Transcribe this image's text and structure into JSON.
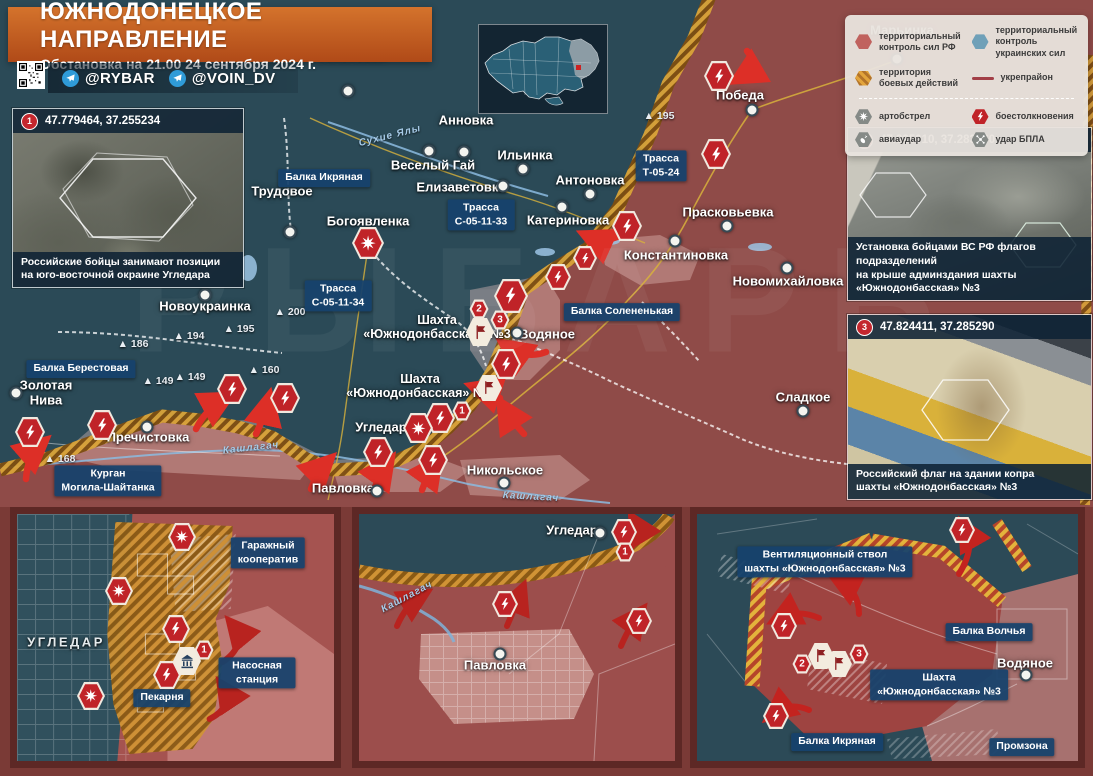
{
  "header": {
    "title": "ЮЖНОДОНЕЦКОЕ НАПРАВЛЕНИЕ",
    "subtitle": "Обстановка на 21.00 24 сентября 2024 г.",
    "channels": [
      {
        "label": "@RYBAR"
      },
      {
        "label": "@VOIN_DV"
      }
    ]
  },
  "legend": {
    "items": [
      {
        "type": "zone-rf",
        "label": "территориальный контроль сил РФ"
      },
      {
        "type": "zone-ua",
        "label": "территориальный контроль украинских сил"
      },
      {
        "type": "zone-combat",
        "label": "территория боевых действий"
      },
      {
        "type": "fortline",
        "label": "укрепрайон"
      },
      {
        "type": "artillery",
        "label": "артобстрел"
      },
      {
        "type": "clash",
        "label": "боестолкновения"
      },
      {
        "type": "airstrike",
        "label": "авиаудар"
      },
      {
        "type": "drone",
        "label": "удар БПЛА"
      }
    ]
  },
  "photos": [
    {
      "num": "1",
      "coords": "47.779464, 37.255234",
      "caption": "Российские бойцы занимают позиции\nна юго-восточной окраине Угледара"
    },
    {
      "num": "2",
      "coords": "47.825010, 37.283660",
      "caption": "Установка бойцами ВС РФ флагов подразделений\nна крыше админздания шахты «Южнодонбасская» №3"
    },
    {
      "num": "3",
      "coords": "47.824411, 37.285290",
      "caption": "Российский флаг на здании копра\nшахты «Южнодонбасская» №3"
    }
  ],
  "map": {
    "watermark": "РЫБАРЬ",
    "towns": [
      {
        "name": "Марьинка",
        "x": 902,
        "y": 31,
        "dot": [
          897,
          59
        ]
      },
      {
        "name": "Победа",
        "x": 740,
        "y": 96,
        "dot": [
          752,
          110
        ]
      },
      {
        "name": "Успеновка",
        "x": 352,
        "y": 56,
        "dot": [
          348,
          91
        ]
      },
      {
        "name": "Анновка",
        "x": 466,
        "y": 121,
        "dot": [
          464,
          152
        ]
      },
      {
        "name": "Трудовое",
        "x": 282,
        "y": 192,
        "dot": [
          290,
          232
        ]
      },
      {
        "name": "Веселый Гай",
        "x": 433,
        "y": 166,
        "dot": [
          429,
          151
        ]
      },
      {
        "name": "Ильинка",
        "x": 525,
        "y": 156,
        "dot": [
          523,
          169
        ]
      },
      {
        "name": "Елизаветовка",
        "x": 461,
        "y": 188,
        "dot": [
          503,
          186
        ]
      },
      {
        "name": "Антоновка",
        "x": 590,
        "y": 181,
        "dot": [
          590,
          194
        ]
      },
      {
        "name": "Катериновка",
        "x": 568,
        "y": 221,
        "dot": [
          562,
          207
        ]
      },
      {
        "name": "Прасковьевка",
        "x": 728,
        "y": 213,
        "dot": [
          727,
          226
        ]
      },
      {
        "name": "Константиновка",
        "x": 676,
        "y": 256,
        "dot": [
          675,
          241
        ]
      },
      {
        "name": "Новомихайловка",
        "x": 788,
        "y": 282,
        "dot": [
          787,
          268
        ]
      },
      {
        "name": "Богоявленка",
        "x": 368,
        "y": 222
      },
      {
        "name": "Новоукраинка",
        "x": 205,
        "y": 307,
        "dot": [
          205,
          295
        ]
      },
      {
        "name": "Золотая\nНива",
        "x": 46,
        "y": 393,
        "dot": [
          16,
          393
        ]
      },
      {
        "name": "Пречистовка",
        "x": 148,
        "y": 438,
        "dot": [
          147,
          427
        ]
      },
      {
        "name": "Угледар",
        "x": 381,
        "y": 428
      },
      {
        "name": "Павловка",
        "x": 343,
        "y": 489,
        "dot": [
          377,
          491
        ]
      },
      {
        "name": "Никольское",
        "x": 505,
        "y": 471,
        "dot": [
          504,
          483
        ]
      },
      {
        "name": "Водяное",
        "x": 547,
        "y": 335,
        "dot": [
          517,
          333
        ]
      },
      {
        "name": "Сладкое",
        "x": 803,
        "y": 398,
        "dot": [
          803,
          411
        ]
      },
      {
        "name": "Шахта\n«Южнодонбасская» №3",
        "x": 437,
        "y": 327,
        "cls": "mine"
      },
      {
        "name": "Шахта\n«Южнодонбасская» №1",
        "x": 420,
        "y": 386,
        "cls": "mine"
      }
    ],
    "area_boxes": [
      {
        "text": "Балка Икряная",
        "x": 324,
        "y": 178
      },
      {
        "text": "Трасса\nС-05-11-33",
        "x": 481,
        "y": 215
      },
      {
        "text": "Трасса\nС-05-11-34",
        "x": 338,
        "y": 296
      },
      {
        "text": "Трасса\nТ-05-24",
        "x": 661,
        "y": 166
      },
      {
        "text": "Балка Солененькая",
        "x": 622,
        "y": 312
      },
      {
        "text": "Балка Берестовая",
        "x": 81,
        "y": 369
      },
      {
        "text": "Курган\nМогила-Шайтанка",
        "x": 108,
        "y": 481
      }
    ],
    "heights": [
      {
        "v": "186",
        "x": 133,
        "y": 344
      },
      {
        "v": "194",
        "x": 189,
        "y": 336
      },
      {
        "v": "195",
        "x": 239,
        "y": 329
      },
      {
        "v": "149",
        "x": 158,
        "y": 381
      },
      {
        "v": "149",
        "x": 190,
        "y": 377
      },
      {
        "v": "160",
        "x": 264,
        "y": 370
      },
      {
        "v": "168",
        "x": 60,
        "y": 459
      },
      {
        "v": "200",
        "x": 290,
        "y": 312
      },
      {
        "v": "195",
        "x": 659,
        "y": 116
      }
    ],
    "rivers": [
      {
        "text": "Сухие Ялы",
        "x": 390,
        "y": 136,
        "rot": -14
      },
      {
        "text": "Кашлагач",
        "x": 251,
        "y": 448,
        "rot": -6
      },
      {
        "text": "Кашлагач",
        "x": 531,
        "y": 497,
        "rot": 3
      }
    ],
    "icons": [
      {
        "t": "clash",
        "x": 719,
        "y": 76
      },
      {
        "t": "clash",
        "x": 716,
        "y": 154
      },
      {
        "t": "clash",
        "x": 627,
        "y": 226
      },
      {
        "t": "clash",
        "x": 585,
        "y": 258,
        "s": 24
      },
      {
        "t": "clash",
        "x": 558,
        "y": 277,
        "s": 26
      },
      {
        "t": "clash",
        "x": 511,
        "y": 296,
        "s": 34
      },
      {
        "t": "clash",
        "x": 506,
        "y": 364
      },
      {
        "t": "clash",
        "x": 440,
        "y": 418
      },
      {
        "t": "clash",
        "x": 433,
        "y": 460
      },
      {
        "t": "clash",
        "x": 378,
        "y": 452
      },
      {
        "t": "clash",
        "x": 285,
        "y": 398
      },
      {
        "t": "clash",
        "x": 232,
        "y": 389
      },
      {
        "t": "clash",
        "x": 102,
        "y": 425
      },
      {
        "t": "clash",
        "x": 30,
        "y": 432
      },
      {
        "t": "artillery",
        "x": 368,
        "y": 243,
        "s": 32
      },
      {
        "t": "artillery",
        "x": 418,
        "y": 428
      },
      {
        "t": "flag",
        "x": 480,
        "y": 332,
        "s": 28
      },
      {
        "t": "flag",
        "x": 489,
        "y": 388,
        "s": 26
      },
      {
        "t": "badge",
        "n": "2",
        "x": 479,
        "y": 309
      },
      {
        "t": "badge",
        "n": "3",
        "x": 500,
        "y": 320
      },
      {
        "t": "badge",
        "n": "1",
        "x": 462,
        "y": 411
      }
    ]
  },
  "insets": [
    {
      "labels": [
        {
          "type": "city",
          "text": "УГЛЕДАР",
          "x": 49,
          "y": 129
        },
        {
          "type": "box",
          "text": "Гаражный кооператив",
          "x": 251,
          "y": 39
        },
        {
          "type": "box",
          "text": "Насосная станция",
          "x": 240,
          "y": 159
        },
        {
          "type": "box",
          "text": "Пекарня",
          "x": 145,
          "y": 184
        }
      ],
      "icons": [
        {
          "t": "artillery",
          "x": 165,
          "y": 23,
          "s": 28
        },
        {
          "t": "artillery",
          "x": 102,
          "y": 77,
          "s": 28
        },
        {
          "t": "artillery",
          "x": 74,
          "y": 182,
          "s": 28
        },
        {
          "t": "clash",
          "x": 159,
          "y": 115,
          "s": 28
        },
        {
          "t": "clash",
          "x": 150,
          "y": 161,
          "s": 28
        },
        {
          "t": "building",
          "x": 170,
          "y": 147,
          "s": 28
        },
        {
          "t": "badge",
          "n": "1",
          "x": 187,
          "y": 136
        }
      ]
    },
    {
      "labels": [
        {
          "type": "town",
          "text": "Угледар",
          "x": 213,
          "y": 17,
          "dot": [
            241,
            19
          ]
        },
        {
          "type": "town",
          "text": "Павловка",
          "x": 136,
          "y": 152,
          "dot": [
            141,
            140
          ]
        },
        {
          "type": "river",
          "text": "Кашлагач",
          "x": 48,
          "y": 83,
          "rot": -28
        }
      ],
      "icons": [
        {
          "t": "clash",
          "x": 265,
          "y": 18,
          "s": 26
        },
        {
          "t": "badge",
          "n": "1",
          "x": 266,
          "y": 38
        },
        {
          "t": "clash",
          "x": 146,
          "y": 90,
          "s": 26
        },
        {
          "t": "clash",
          "x": 280,
          "y": 107,
          "s": 26
        }
      ]
    },
    {
      "labels": [
        {
          "type": "box",
          "text": "Вентиляционный ствол\nшахты «Южнодонбасская» №3",
          "x": 128,
          "y": 48
        },
        {
          "type": "box",
          "text": "Балка Волчья",
          "x": 292,
          "y": 118
        },
        {
          "type": "town",
          "text": "Водяное",
          "x": 328,
          "y": 150,
          "dot": [
            329,
            161
          ]
        },
        {
          "type": "box",
          "text": "Шахта\n«Южнодонбасская» №3",
          "x": 242,
          "y": 171
        },
        {
          "type": "box",
          "text": "Балка Икряная",
          "x": 140,
          "y": 228
        },
        {
          "type": "box",
          "text": "Промзона",
          "x": 325,
          "y": 233
        }
      ],
      "icons": [
        {
          "t": "clash",
          "x": 265,
          "y": 16,
          "s": 26
        },
        {
          "t": "clash",
          "x": 87,
          "y": 112,
          "s": 26
        },
        {
          "t": "clash",
          "x": 79,
          "y": 202,
          "s": 26
        },
        {
          "t": "flag",
          "x": 124,
          "y": 142,
          "s": 26
        },
        {
          "t": "flag",
          "x": 142,
          "y": 150,
          "s": 26
        },
        {
          "t": "badge",
          "n": "2",
          "x": 105,
          "y": 150
        },
        {
          "t": "badge",
          "n": "3",
          "x": 162,
          "y": 140
        }
      ]
    }
  ],
  "colors": {
    "accent_orange": "#c75b21",
    "zone_rf": "#8e4a47",
    "zone_ua": "#2b4a57",
    "zone_combat": "#d39a35",
    "label_blue": "#16426c",
    "icon_red": "#c02328",
    "caption_bg": "#0e2234"
  }
}
